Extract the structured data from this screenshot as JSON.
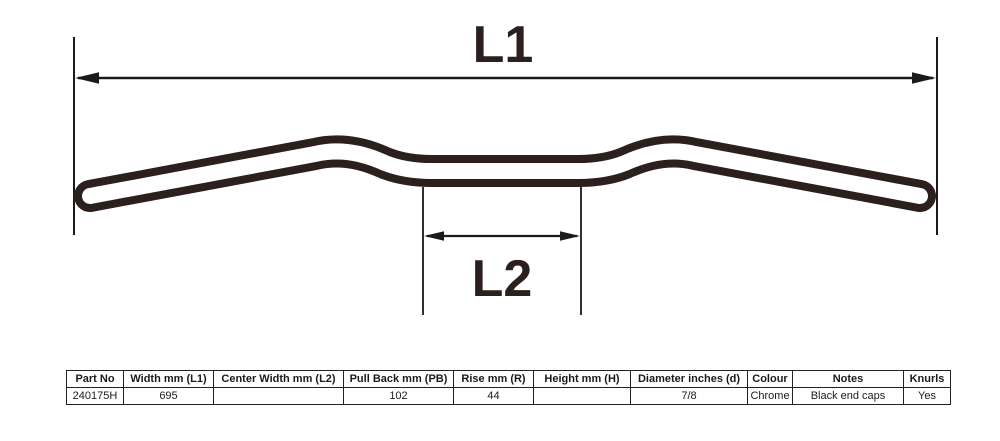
{
  "diagram": {
    "dimension_labels": {
      "l1": "L1",
      "l2": "L2"
    },
    "tube_color": "#2b201d",
    "line_color": "#1a1a1a"
  },
  "table": {
    "columns": [
      "Part No",
      "Width mm (L1)",
      "Center Width mm (L2)",
      "Pull Back mm (PB)",
      "Rise mm (R)",
      "Height mm (H)",
      "Diameter inches (d)",
      "Colour",
      "Notes",
      "Knurls"
    ],
    "rows": [
      [
        "240175H",
        "695",
        "",
        "102",
        "44",
        "",
        "7/8",
        "Chrome",
        "Black end caps",
        "Yes"
      ]
    ]
  }
}
